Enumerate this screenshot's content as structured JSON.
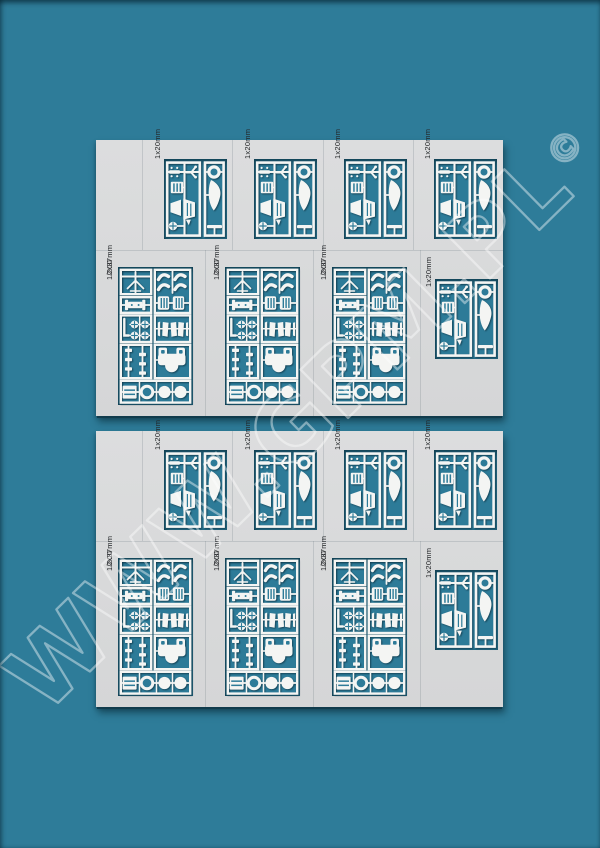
{
  "colors": {
    "background_teal": "#2e7c99",
    "sheet_grey": "#d9dadb",
    "window_teal": "#2d7b98",
    "parts_white": "#f4f5f3",
    "shadow_dark": "#0a2c3c",
    "watermark_white": "#ffffff"
  },
  "watermark": {
    "text": "WWW.GPM.PL",
    "copyright": "©"
  },
  "labels": {
    "scale": "1/200",
    "caliber_small": "1x20mm",
    "caliber_large": "2x37mm"
  },
  "sheets": [
    {
      "name": "parts-sheet-1",
      "panels": [
        {
          "type": "small",
          "caliber": "1x20mm"
        },
        {
          "type": "small",
          "caliber": "1x20mm"
        },
        {
          "type": "small",
          "caliber": "1x20mm"
        },
        {
          "type": "small",
          "caliber": "1x20mm"
        },
        {
          "type": "large",
          "scale": "1/200",
          "caliber": "2x37mm"
        },
        {
          "type": "large",
          "scale": "1/200",
          "caliber": "2x37mm"
        },
        {
          "type": "large",
          "scale": "1/200",
          "caliber": "2x37mm"
        },
        {
          "type": "small",
          "caliber": "1x20mm"
        }
      ]
    },
    {
      "name": "parts-sheet-2",
      "panels": [
        {
          "type": "small",
          "caliber": "1x20mm"
        },
        {
          "type": "small",
          "caliber": "1x20mm"
        },
        {
          "type": "small",
          "caliber": "1x20mm"
        },
        {
          "type": "small",
          "caliber": "1x20mm"
        },
        {
          "type": "large",
          "scale": "1/200",
          "caliber": "2x37mm"
        },
        {
          "type": "large",
          "scale": "1/200",
          "caliber": "2x37mm"
        },
        {
          "type": "large",
          "scale": "1/200",
          "caliber": "2x37mm"
        },
        {
          "type": "small",
          "caliber": "1x20mm"
        }
      ]
    }
  ]
}
